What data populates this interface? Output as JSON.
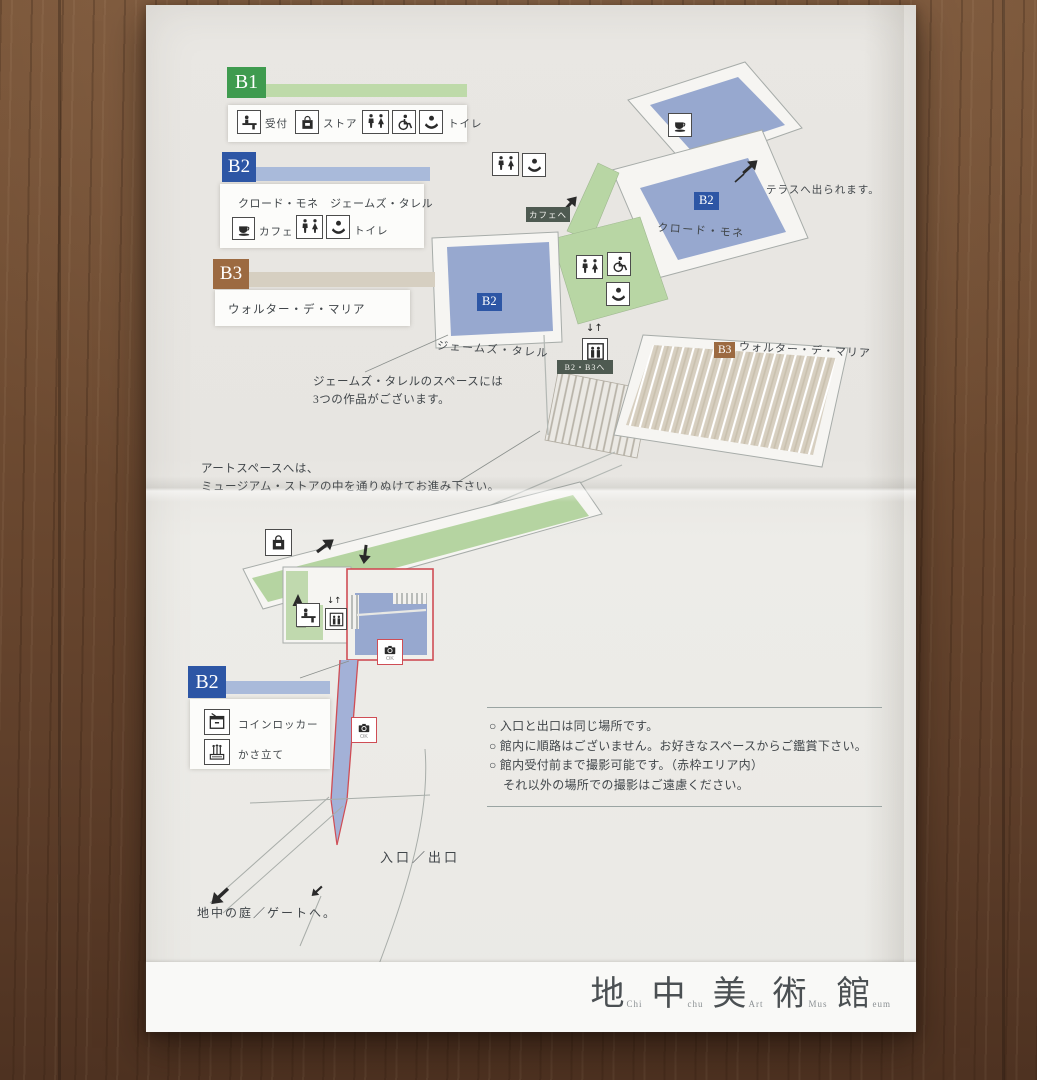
{
  "legends": {
    "b1": {
      "floor": "B1",
      "reception": "受付",
      "store": "ストア",
      "toilet": "トイレ"
    },
    "b2": {
      "floor": "B2",
      "artists": "クロード・モネ　ジェームズ・タレル",
      "cafe": "カフェ",
      "toilet": "トイレ"
    },
    "b3": {
      "floor": "B3",
      "artist": "ウォルター・デ・マリア"
    },
    "b2_lower": {
      "floor": "B2",
      "locker": "コインロッカー",
      "umbrella": "かさ立て"
    }
  },
  "map": {
    "monet": {
      "floor": "B2",
      "label": "クロード・モネ"
    },
    "turrell": {
      "floor": "B2",
      "label": "ジェームズ・タレル"
    },
    "de_maria": {
      "floor": "B3",
      "label": "ウォルター・デ・マリア"
    },
    "signs": {
      "cafe": "カフェへ",
      "b2b3": "B2・B3へ",
      "elevator": "↓↑",
      "camera_ok": "OK"
    },
    "notes": {
      "terrace": "テラスへ出られます。",
      "turrell_line1": "ジェームズ・タレルのスペースには",
      "turrell_line2": "3つの作品がございます。",
      "artspace_line1": "アートスペースへは、",
      "artspace_line2": "ミュージアム・ストアの中を通りぬけてお進み下さい。",
      "entrance": "入口／出口",
      "garden": "地中の庭／ゲートへ。"
    }
  },
  "guidelines": {
    "line1": "○ 入口と出口は同じ場所です。",
    "line2": "○ 館内に順路はございません。お好きなスペースからご鑑賞下さい。",
    "line3": "○ 館内受付前まで撮影可能です。（赤枠エリア内）",
    "line4": "それ以外の場所での撮影はご遠慮ください。"
  },
  "logo": {
    "chars": [
      {
        "kanji": "地",
        "latin": "Chi"
      },
      {
        "kanji": "中",
        "latin": "chu"
      },
      {
        "kanji": "美",
        "latin": "Art"
      },
      {
        "kanji": "術",
        "latin": "Mus"
      },
      {
        "kanji": "館",
        "latin": "eum"
      }
    ]
  },
  "colors": {
    "b1_green": "#3f9b4f",
    "b1_bar": "#bedaa9",
    "b2_blue": "#2d56a5",
    "b2_bar": "#a9bada",
    "b3_brown": "#9c6a41",
    "b3_bar": "#d6cfc1",
    "room_blue": "#97a8cf",
    "corridor_green": "#b8d6a4",
    "sign_dark": "#4e5a51",
    "camera_frame_red": "#cf4d55"
  }
}
